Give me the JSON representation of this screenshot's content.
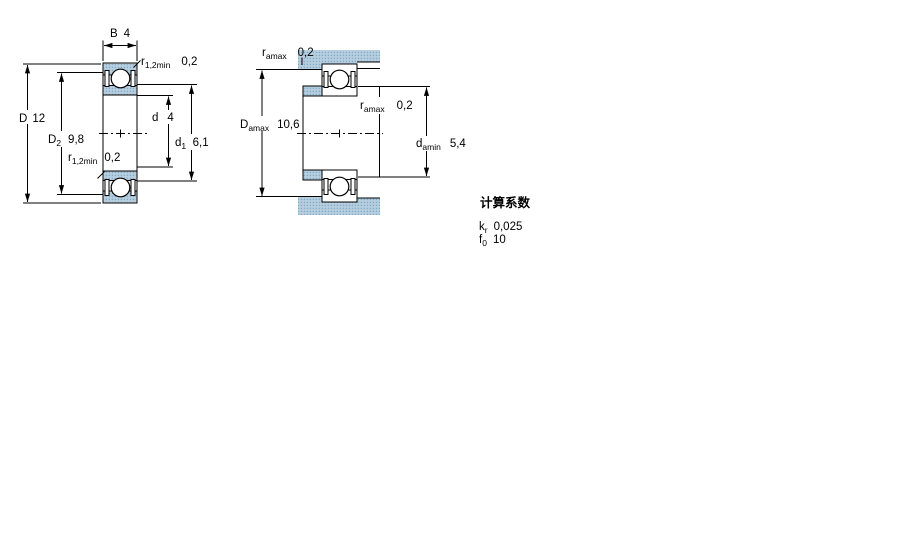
{
  "figure": {
    "description": "Deep groove ball bearing cross-section and abutment dimension drawing",
    "colors": {
      "line": "#000000",
      "section_fill": "#b6cedf",
      "section_dot": "#85abc4"
    }
  },
  "left_view": {
    "labels": {
      "B": {
        "sym": "B",
        "val": "4"
      },
      "r12_top": {
        "sym": "r",
        "sub": "1,2min",
        "val": "0,2"
      },
      "D": {
        "sym": "D",
        "val": "12"
      },
      "D2": {
        "sym": "D",
        "sub": "2",
        "val": "9,8"
      },
      "d": {
        "sym": "d",
        "val": "4"
      },
      "d1": {
        "sym": "d",
        "sub": "1",
        "val": "6,1"
      },
      "r12_bottom": {
        "sym": "r",
        "sub": "1,2min",
        "val": "0,2"
      }
    }
  },
  "right_view": {
    "labels": {
      "ra_top": {
        "sym": "r",
        "sub": "amax",
        "val": "0,2"
      },
      "Da": {
        "sym": "D",
        "sub": "amax",
        "val": "10,6"
      },
      "ra_mid": {
        "sym": "r",
        "sub": "amax",
        "val": "0,2"
      },
      "da": {
        "sym": "d",
        "sub": "amin",
        "val": "5,4"
      }
    }
  },
  "factors": {
    "heading": "计算系数",
    "rows": [
      {
        "sym": "k",
        "sub": "r",
        "val": "0,025"
      },
      {
        "sym": "f",
        "sub": "0",
        "val": "10"
      }
    ]
  }
}
